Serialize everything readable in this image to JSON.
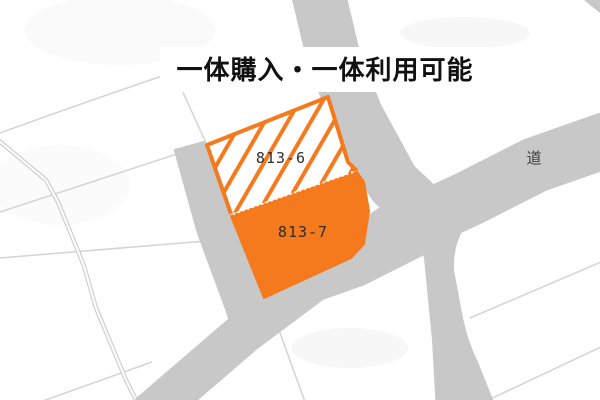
{
  "title": {
    "text": "一体購入・一体利用可能"
  },
  "map": {
    "parcels": [
      {
        "label": "813-6",
        "fill_style": "white-with-orange-diagonal-hatch"
      },
      {
        "label": "813-7",
        "fill_style": "solid-orange"
      }
    ],
    "road_label": "道",
    "colors": {
      "parcel_orange": "#f5791d",
      "road_gray": "#c8c8c8",
      "boundary_line_gray": "#d4d4d4",
      "title_text": "#111111",
      "parcel_label_text": "#2e2e2e",
      "road_label_text": "#3c3c3c",
      "background": "#ffffff"
    }
  }
}
